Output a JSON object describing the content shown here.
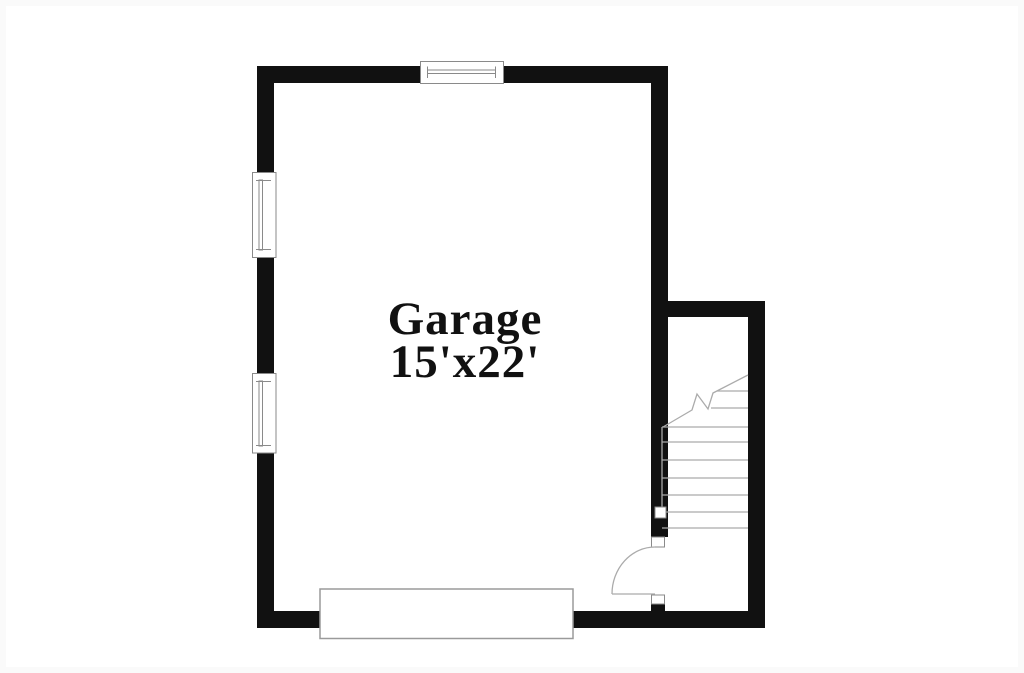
{
  "canvas": {
    "width": 1024,
    "height": 673,
    "background": "#ffffff"
  },
  "room": {
    "label": "Garage",
    "dimensions": "15'x22'"
  },
  "colors": {
    "wall": "#111111",
    "window_frame_line": "#8a8a8a",
    "stair_line": "#ababab",
    "door_swing_line": "#ababab",
    "garage_door_border": "#9a9a9a",
    "text": "#111111",
    "background": "#ffffff"
  },
  "features": {
    "windows_count": 3,
    "stairs": {
      "full_treads_visible": 7,
      "partial_treads_above_break": 2,
      "has_diagonal_break_line": true
    },
    "interior_door_count": 1,
    "garage_door_count": 1
  }
}
